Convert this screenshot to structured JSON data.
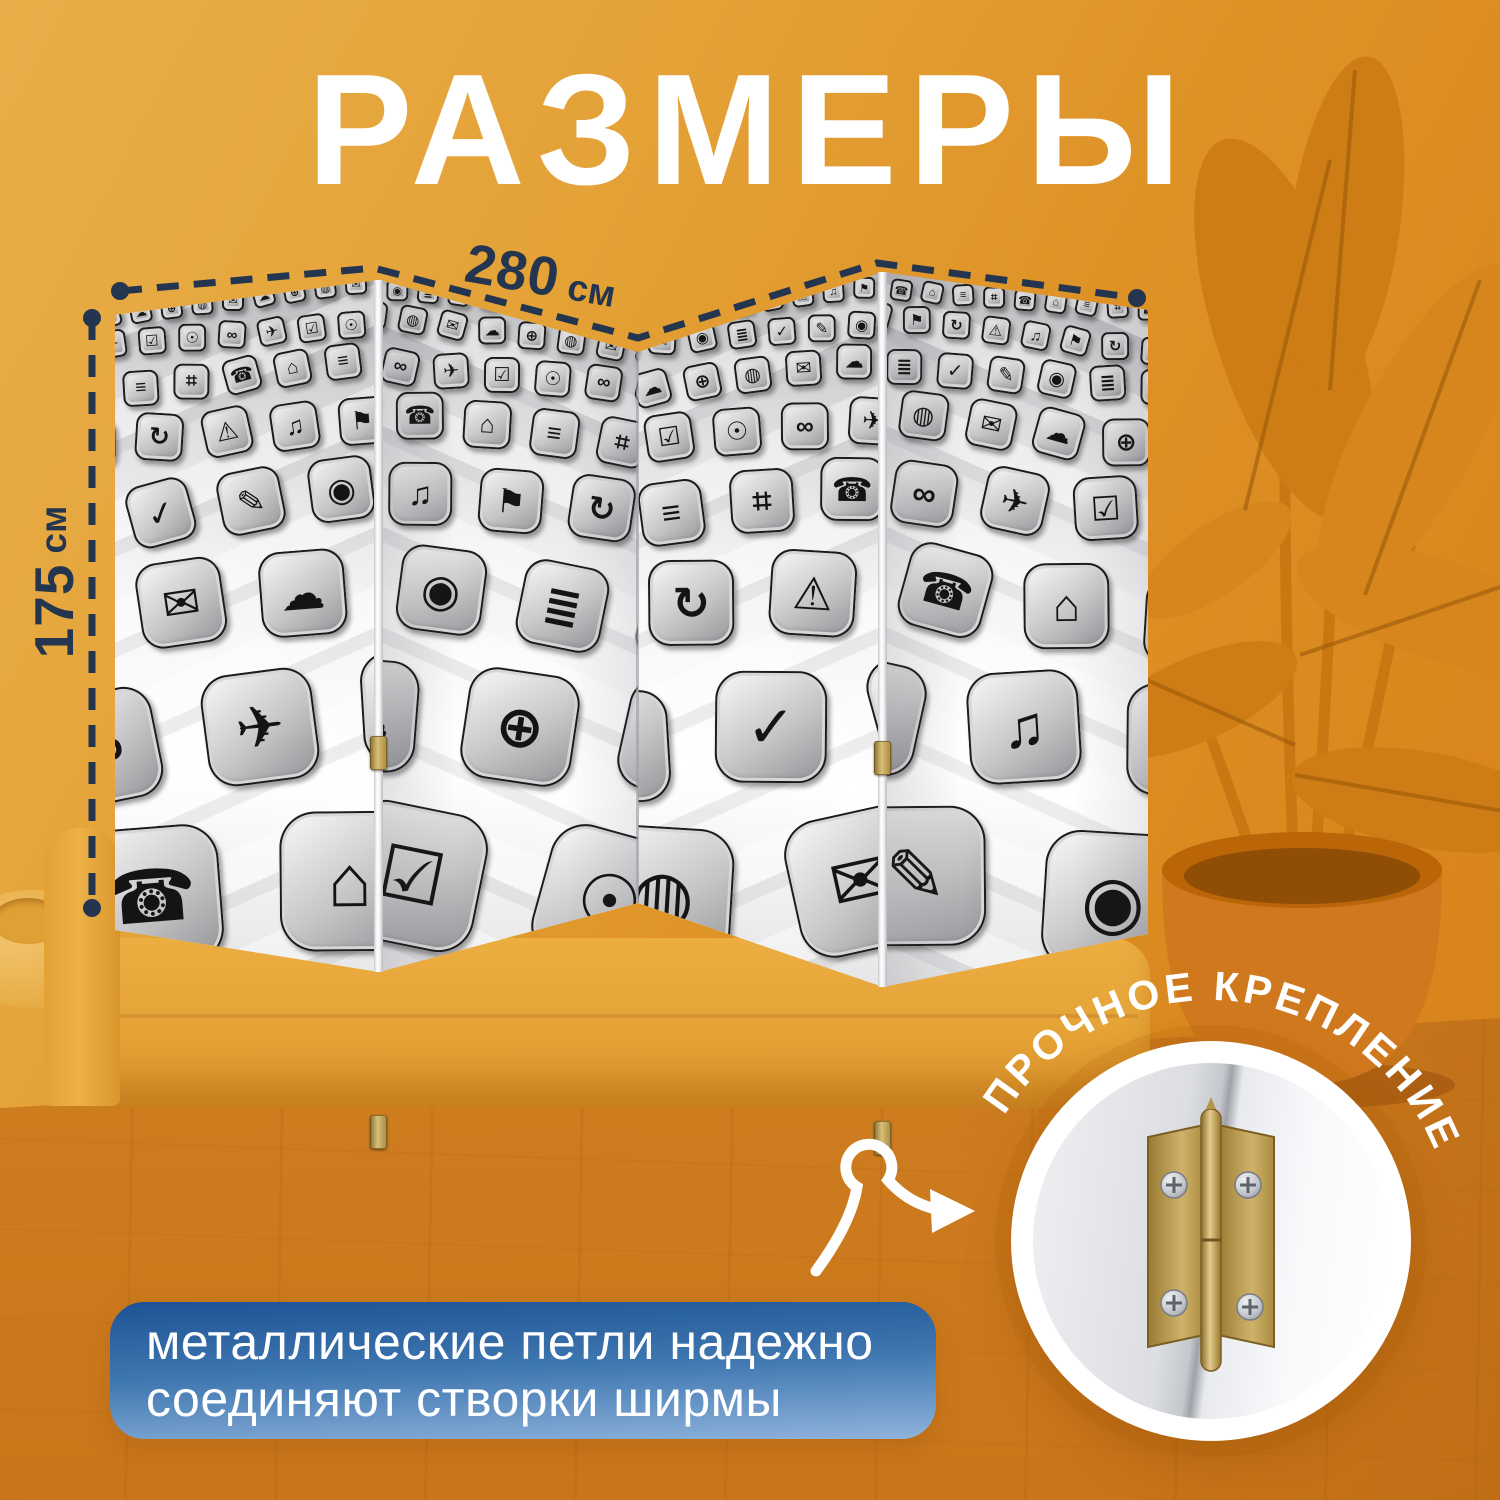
{
  "page": {
    "title": "РАЗМЕРЫ"
  },
  "dimensions": {
    "width": {
      "value": "280",
      "unit": "см"
    },
    "height": {
      "value": "175",
      "unit": "см"
    }
  },
  "callout": {
    "line1": "металлические петли надежно",
    "line2": "соединяют створки ширмы"
  },
  "badge": {
    "curved_text": "ПРОЧНОЕ КРЕПЛЕНИЕ"
  },
  "screen": {
    "panel_count": 4,
    "pattern_icons": [
      "✉",
      "☎",
      "✎",
      "✈",
      "♫",
      "☁",
      "⌂",
      "◉",
      "☑",
      "⚑",
      "⊕",
      "≡",
      "≣",
      "☉",
      "↻",
      "◍",
      "⌗",
      "✓",
      "∞",
      "⚠"
    ]
  },
  "colors": {
    "background_top": "#E9AE49",
    "background_right": "#D47F19",
    "accent_navy": "#24364F",
    "callout_blue_top": "#1D5395",
    "callout_blue_bottom": "#8FB3DC",
    "hinge_brass": "#C9A85E",
    "title_white": "#FFFFFF"
  }
}
